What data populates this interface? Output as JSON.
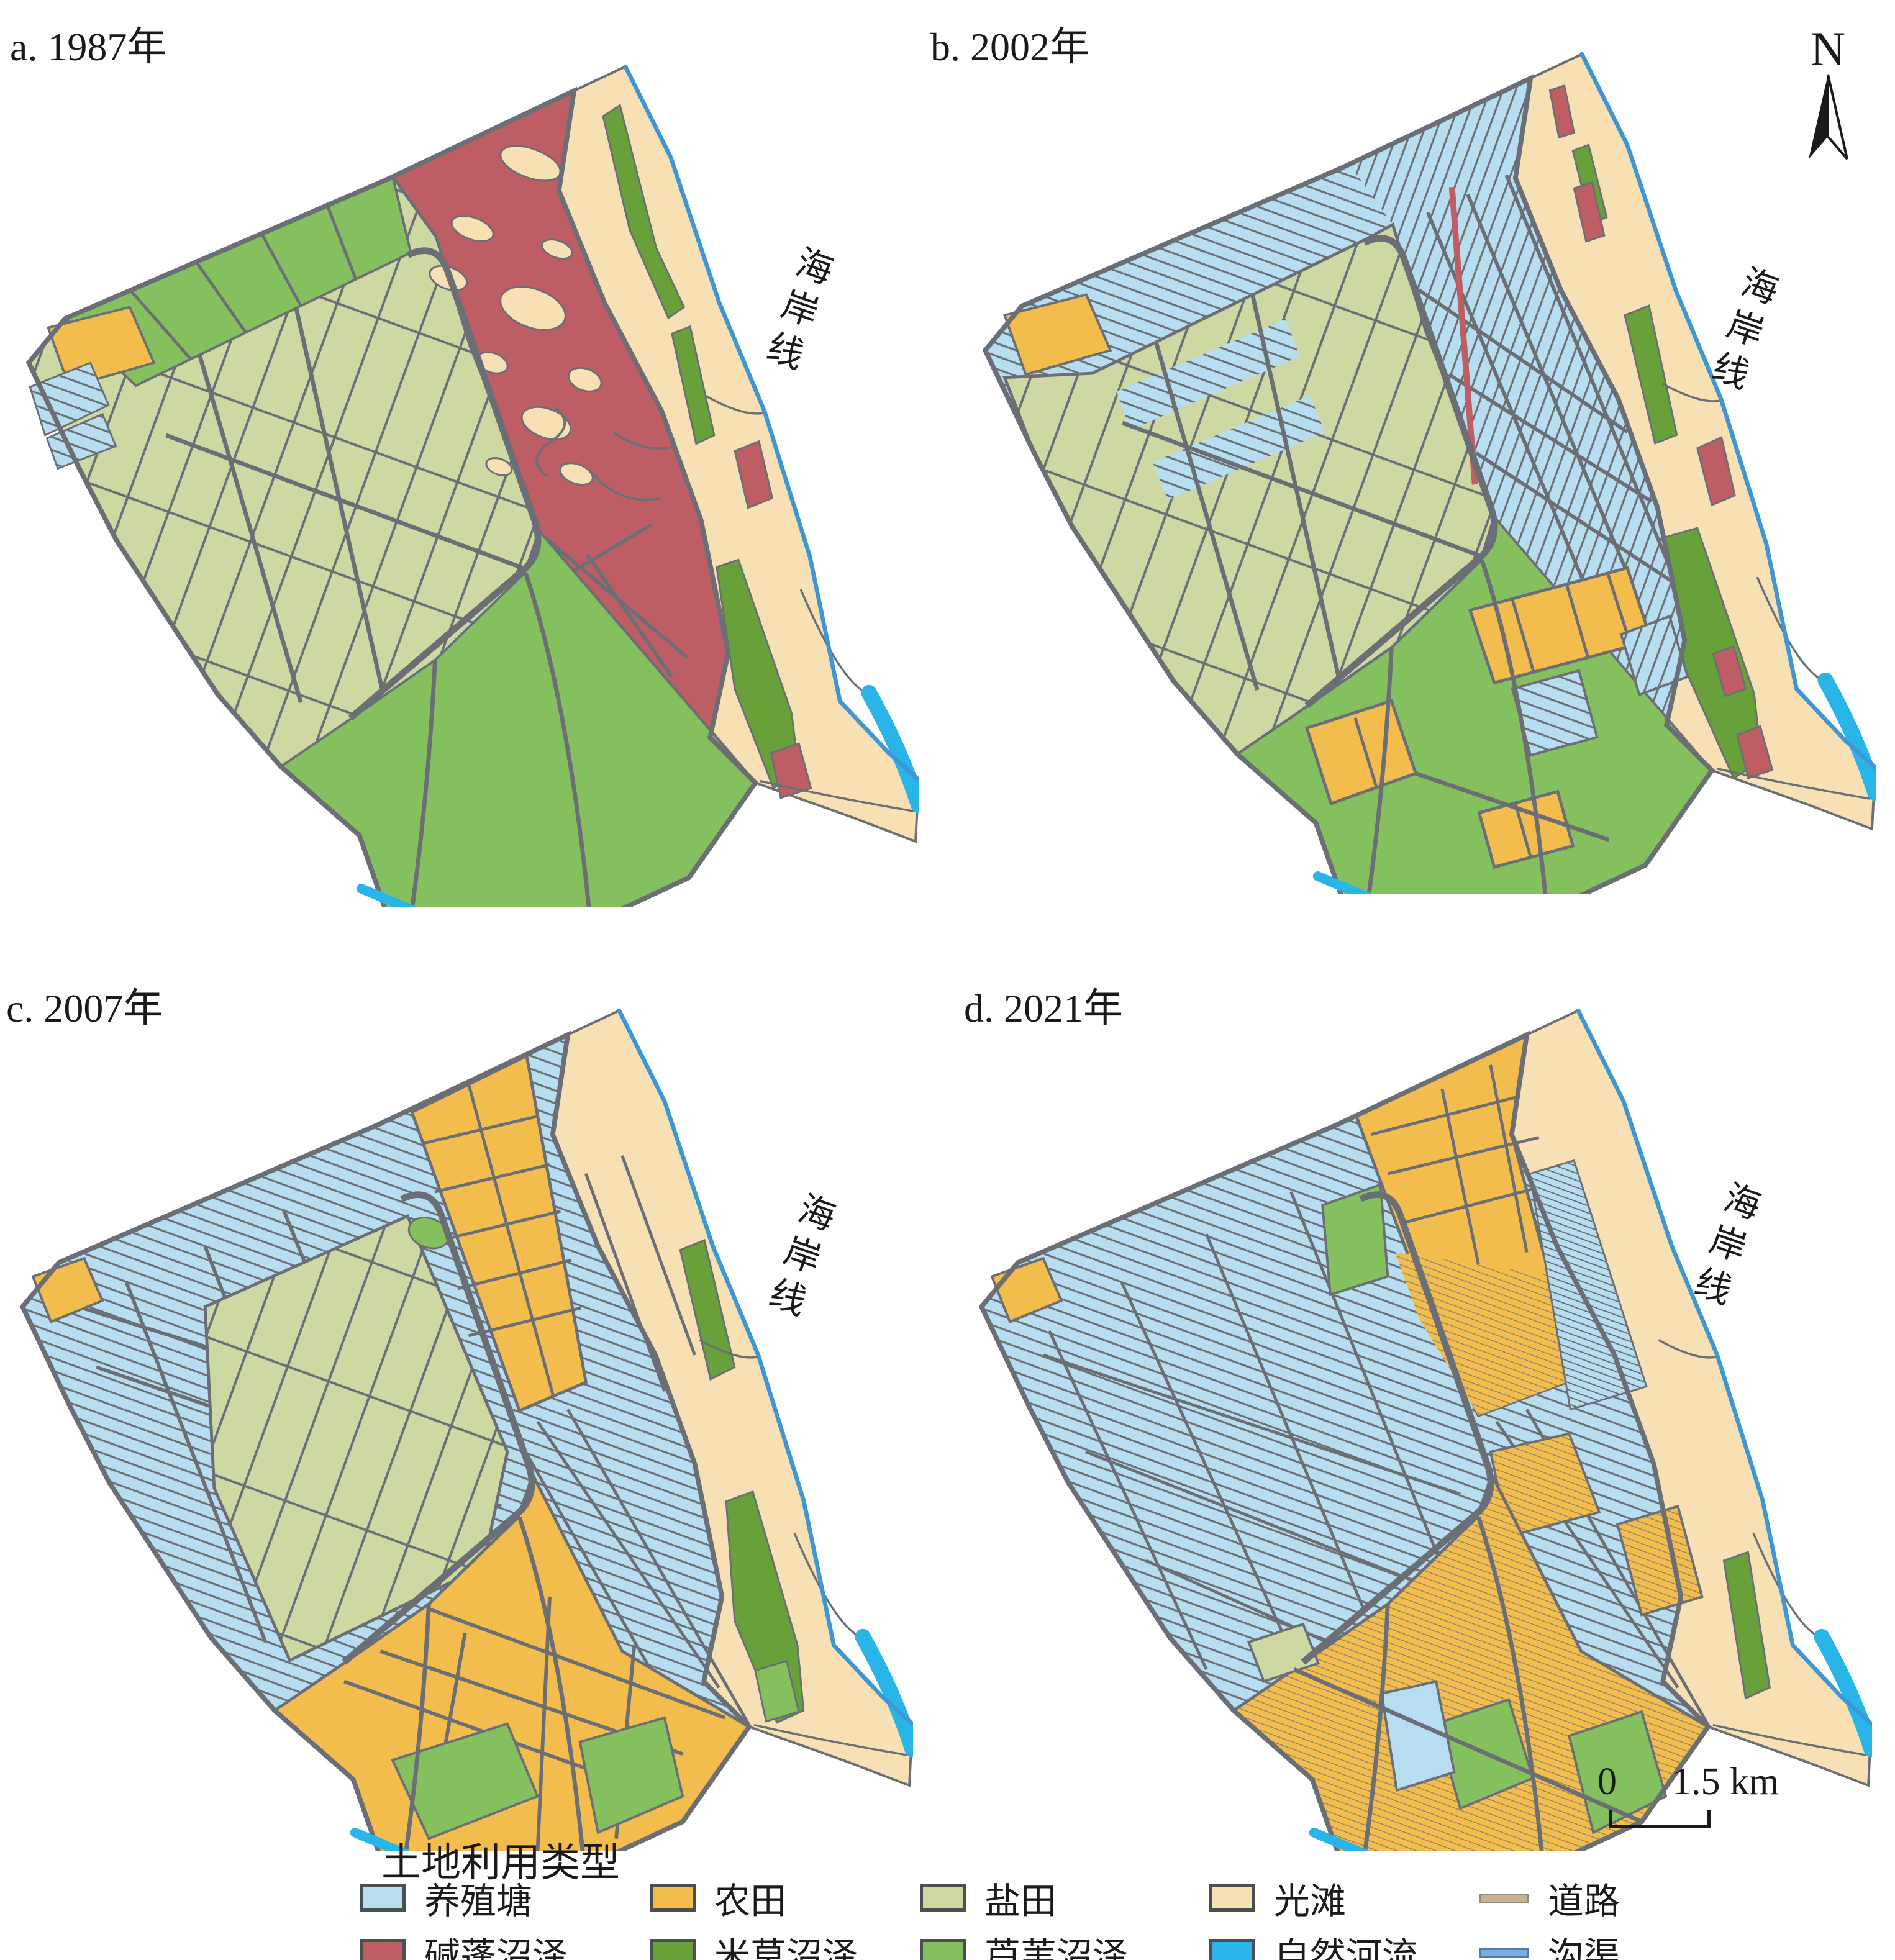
{
  "figure": {
    "panels": [
      {
        "id": "a",
        "label": "a. 1987年",
        "coast_label": "海岸线"
      },
      {
        "id": "b",
        "label": "b. 2002年",
        "coast_label": "海岸线"
      },
      {
        "id": "c",
        "label": "c. 2007年",
        "coast_label": "海岸线"
      },
      {
        "id": "d",
        "label": "d. 2021年",
        "coast_label": "海岸线"
      }
    ],
    "compass": {
      "label": "N"
    },
    "scale_bar": {
      "zero": "0",
      "max": "1.5 km"
    }
  },
  "legend": {
    "title": "土地利用类型",
    "items": [
      {
        "key": "pond",
        "label": "养殖塘",
        "color": "#b7ddf1",
        "swatch": "rect"
      },
      {
        "key": "farmland",
        "label": "农田",
        "color": "#f3bd4d",
        "swatch": "rect"
      },
      {
        "key": "saltpan",
        "label": "盐田",
        "color": "#cdd8a3",
        "swatch": "rect"
      },
      {
        "key": "flat",
        "label": "光滩",
        "color": "#f6e0b4",
        "swatch": "rect"
      },
      {
        "key": "road",
        "label": "道路",
        "color": "#cdb48e",
        "swatch": "line"
      },
      {
        "key": "suaeda",
        "label": "碱蓬沼泽",
        "color": "#bf5d65",
        "swatch": "rect"
      },
      {
        "key": "spartina",
        "label": "米草沼泽",
        "color": "#68a039",
        "swatch": "rect"
      },
      {
        "key": "reed",
        "label": "芦苇沼泽",
        "color": "#85c05e",
        "swatch": "rect"
      },
      {
        "key": "river",
        "label": "自然河流",
        "color": "#2ab5e8",
        "swatch": "rect"
      },
      {
        "key": "ditch",
        "label": "沟渠",
        "color": "#7caede",
        "swatch": "line"
      }
    ]
  },
  "map_colors": {
    "outline": "#6b6f75",
    "coast": "#3e96d7"
  }
}
